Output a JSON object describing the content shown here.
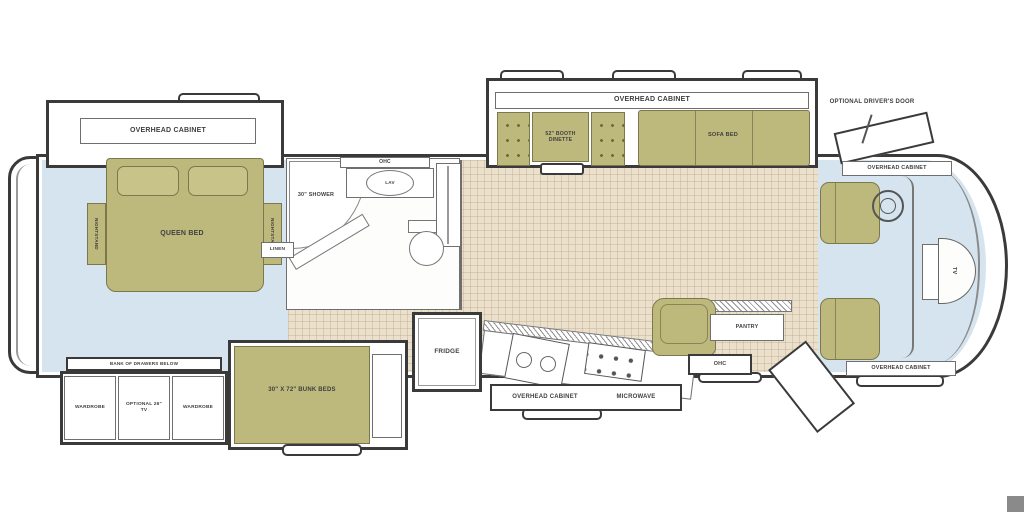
{
  "colors": {
    "furniture": "#bdb97c",
    "furniture_border": "#7d784c",
    "carpet": "#d5e4ee",
    "tile": "#ebe0cc",
    "wall": "#3a3a3a"
  },
  "bedroom": {
    "overhead_cabinet": "OVERHEAD CABINET",
    "queen_bed": "QUEEN BED",
    "nightstand": "NIGHTSTAND",
    "linen": "LINEN"
  },
  "bathroom": {
    "shower": "30\" SHOWER",
    "lav": "LAV",
    "ohc": "OHC"
  },
  "living": {
    "overhead_cabinet": "OVERHEAD CABINET",
    "dinette": "52\" BOOTH DINETTE",
    "sofa_bed": "SOFA BED"
  },
  "cockpit": {
    "optional_door": "OPTIONAL DRIVER'S DOOR",
    "overhead_cabinet_top": "OVERHEAD CABINET",
    "overhead_cabinet_bottom": "OVERHEAD CABINET",
    "front_tv": "TV"
  },
  "storage": {
    "drawers_strip": "BANK OF DRAWERS BELOW",
    "wardrobe_left": "WARDROBE",
    "optional_tv": "OPTIONAL 26\" TV",
    "wardrobe_right": "WARDROBE"
  },
  "bunks": {
    "label": "30\" X 72\" BUNK BEDS"
  },
  "kitchen": {
    "fridge": "FRIDGE",
    "overhead_cabinet": "OVERHEAD CABINET",
    "microwave": "MICROWAVE",
    "pantry": "PANTRY",
    "ohc": "OHC"
  }
}
